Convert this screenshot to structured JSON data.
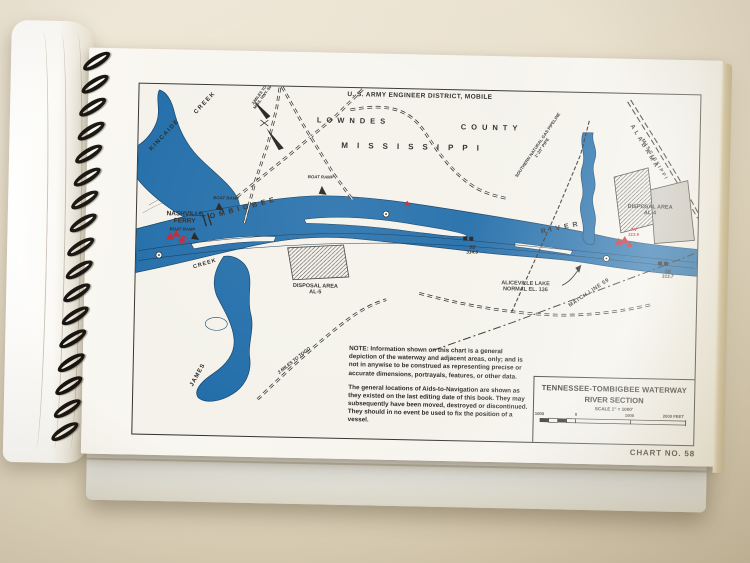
{
  "colors": {
    "chart-paper": "#f4f2ea",
    "ink": "#26241f",
    "river": "#1e6ba8",
    "aid-red": "#c4202c",
    "hatch-gray": "#c8c4ba"
  },
  "chart": {
    "agency": "U. S. ARMY ENGINEER DISTRICT, MOBILE",
    "chart_no": "CHART NO. 58",
    "title_block": {
      "line1": "TENNESSEE-TOMBIGBEE WATERWAY",
      "line2": "RIVER SECTION",
      "scale": "SCALE 1\" = 1000'",
      "ticks": [
        "1000",
        "0",
        "1000",
        "2000 FEET"
      ]
    },
    "notes": {
      "para1": "NOTE: Information shown on this chart is a general depiction of the waterway and adjacent areas, only; and is not in anywise to be construed as representing precise or accurate dimensions, portrayals, features, or other data.",
      "para2": "The general locations of Aids-to-Navigation are shown as they existed on the last editing date of this book. They may subsequently have been moved, destroyed or discontinued. They should in no event be used to fix the position of a vessel."
    },
    "labels": {
      "county_1": "LOWNDES",
      "county_2": "COUNTY",
      "state": "MISSISSIPPI",
      "kincaide": "KINCAIDE",
      "creek": "CREEK",
      "nashville_ferry_1": "NASHVILLE",
      "nashville_ferry_2": "FERRY",
      "boat_ramp": "BOAT RAMP",
      "tombigbee": "TOMBIGBEE",
      "river_word": "RIVER",
      "james": "JAMES",
      "disposal_area": "DISPOSAL AREA",
      "al5": "AL-5",
      "al4": "AL-4",
      "aliceville_1": "ALICEVILLE LAKE",
      "aliceville_2": "NORMAL EL. 136",
      "match_line": "MATCH LINE 59",
      "pipeline_1": "SOUTHERN NATURAL GAS PIPELINE",
      "pipeline_2": "1'-20\" PIPE",
      "alabama": "ALABAMA",
      "mississippi_diag": "MISSISSIPPI",
      "togo": "3 MILES TO TOGO",
      "miles_top_1": "2 MILES TO",
      "miles_top_2": "MISS. HWY. 50"
    },
    "aids": {
      "sb1_1": "SB",
      "sb1_2": "314.6",
      "sb2_1": "SB",
      "sb2_2": "313.7",
      "tn1_1": "TN",
      "tn1_2": "315.4",
      "tn2_1": "TN",
      "tn2_2": "313.9"
    }
  }
}
